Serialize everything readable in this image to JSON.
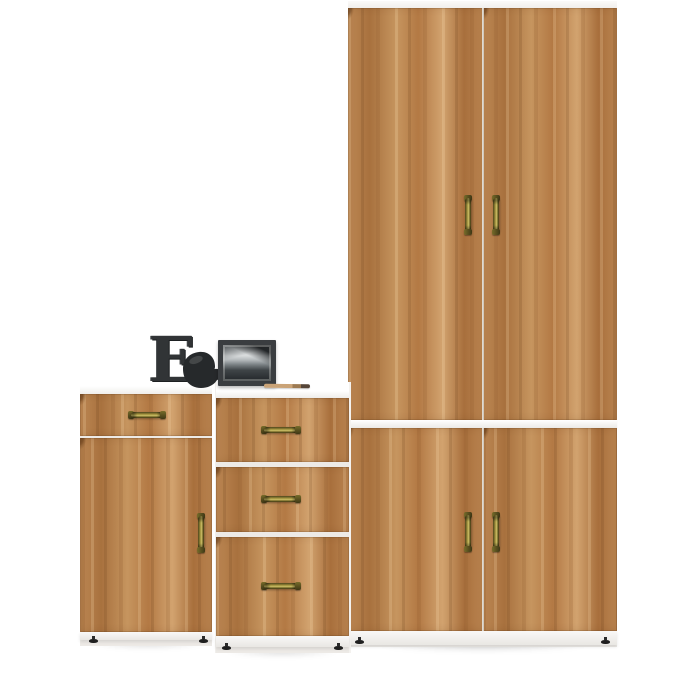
{
  "scene": {
    "title": "Product photo of a three-piece oak and white furniture set",
    "background_color": "#ffffff"
  },
  "palette": {
    "wood_base": "#bc8a58",
    "wood_dark_grain": "#99663a",
    "wood_light_grain": "#d9b487",
    "carcass_white": "#f7f6f4",
    "handle_brass_light": "#cfc268",
    "handle_brass_dark": "#3e3715",
    "foot_black": "#1f1f1f",
    "decor_charcoal": "#313436"
  },
  "furniture": {
    "wardrobe": {
      "name": "tall wardrobe with upper and lower double doors",
      "upper_doors": 2,
      "lower_doors": 2,
      "handles": 4,
      "handle_style": "antique brass vertical pulls"
    },
    "chest": {
      "name": "three-drawer chest",
      "drawers": 3,
      "handles": 3,
      "handle_style": "antique brass horizontal pulls"
    },
    "cabinet": {
      "name": "cabinet with one drawer and one door",
      "drawers": 1,
      "doors": 1,
      "handles": 2
    }
  },
  "decor": {
    "letter": {
      "glyph": "E",
      "name": "decorative charcoal letter E",
      "color": "#313436"
    },
    "figurine": {
      "name": "black bird figurine"
    },
    "photo_frame": {
      "name": "black-and-white landscape photo in dark frame"
    },
    "pencil": {
      "name": "wooden pencil"
    }
  }
}
